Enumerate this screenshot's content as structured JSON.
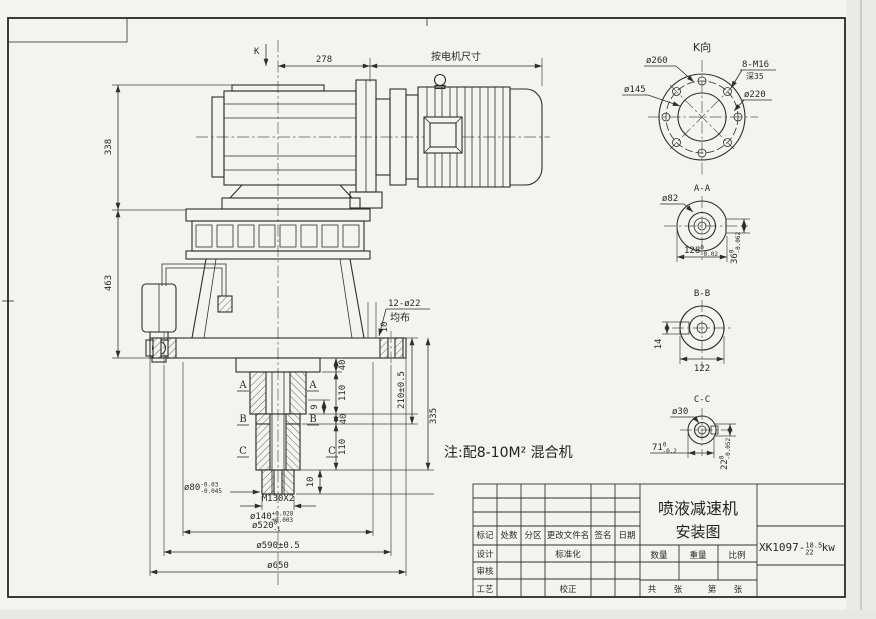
{
  "palette": {
    "paper": "#f5f3ee",
    "ink": "#2f2e2b"
  },
  "note": "注:配8-10M² 混合机",
  "main_view": {
    "k_arrow": "K",
    "dim_278": "278",
    "dim_motor": "按电机尺寸",
    "dim_338": "338",
    "dim_463": "463",
    "holes_label": "12-ø22",
    "holes_sub": "均布",
    "dim_10_flange": "10",
    "dim_40_top": "40",
    "dim_110_upper": "110",
    "dim_9": "9",
    "dim_40_mid": "40",
    "dim_110_lower": "110",
    "dim_10_tip": "10",
    "dim_210": "210±0.5",
    "dim_335": "335",
    "dim_80": {
      "main": "ø80",
      "tol_up": "-0.03",
      "tol_dn": "-0.045"
    },
    "thread": "M130X2",
    "dim_140": {
      "main": "ø140",
      "tol_up": "+0.028",
      "tol_dn": "+0.003"
    },
    "dim_520": {
      "main": "ø520",
      "tol_up": "0",
      "tol_dn": "-1"
    },
    "dim_590": "ø590±0.5",
    "dim_650": "ø650",
    "sec_a": "A",
    "sec_b": "B",
    "sec_c": "C"
  },
  "k_view": {
    "label": "K向",
    "d260": "ø260",
    "d145": "ø145",
    "bolt_spec": "8-M16",
    "bolt_depth": "深35",
    "d220": "ø220"
  },
  "aa_view": {
    "label": "A-A",
    "d82": "ø82",
    "w128": {
      "main": "128",
      "tol_up": "0",
      "tol_dn": "-0.02"
    },
    "h36": {
      "main": "36",
      "tol_up": "0",
      "tol_dn": "-0.062"
    }
  },
  "bb_view": {
    "label": "B-B",
    "h14": "14",
    "w122": "122"
  },
  "cc_view": {
    "label": "C-C",
    "d30": "ø30",
    "w71": {
      "main": "71",
      "tol_up": "0",
      "tol_dn": "-0.2"
    },
    "h22": {
      "main": "22",
      "tol_up": "0",
      "tol_dn": "-0.052"
    }
  },
  "title_block": {
    "title_line1": "喷液减速机",
    "title_line2": "安装图",
    "code_prefix": "XK1097-",
    "code_frac_top": "18.5",
    "code_frac_bottom": "22",
    "code_suffix": "kw",
    "col_mark": "标记",
    "col_count": "处数",
    "col_zone": "分区",
    "col_file": "更改文件名",
    "col_sign": "签名",
    "col_date": "日期",
    "row_design": "设计",
    "row_standard": "标准化",
    "row_check": "审核",
    "row_process": "工艺",
    "row_correct": "校正",
    "qty": "数量",
    "weight": "重量",
    "scale": "比例",
    "total_label": "共",
    "sheet_unit_a": "张",
    "page_label": "第",
    "sheet_unit_b": "张"
  }
}
